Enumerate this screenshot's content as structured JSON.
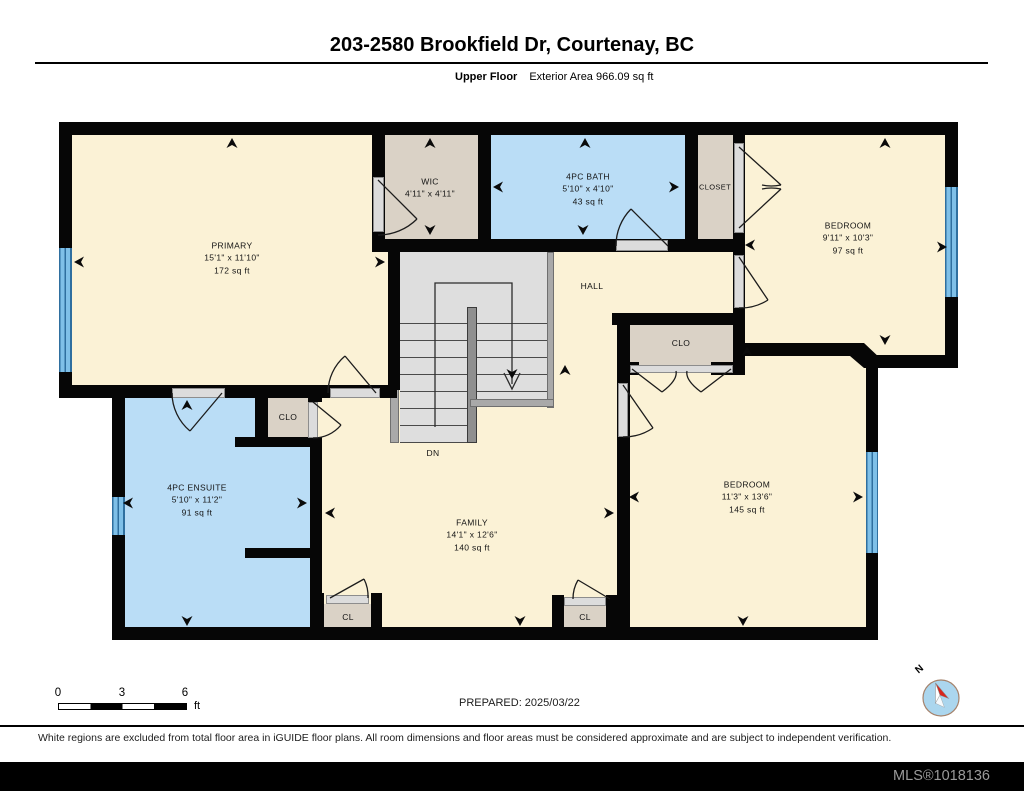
{
  "header": {
    "title": "203-2580 Brookfield Dr, Courtenay, BC",
    "floor_label": "Upper Floor",
    "area_label": "Exterior Area 966.09 sq ft"
  },
  "rooms": {
    "primary": {
      "name": "PRIMARY",
      "dims": "15'1\" x 11'10\"",
      "area": "172 sq ft"
    },
    "wic": {
      "name": "WIC",
      "dims": "4'11\" x 4'11\""
    },
    "bath": {
      "name": "4PC BATH",
      "dims": "5'10\" x 4'10\"",
      "area": "43 sq ft"
    },
    "closet_top": {
      "name": "CLOSET"
    },
    "bedroom_top": {
      "name": "BEDROOM",
      "dims": "9'11\" x 10'3\"",
      "area": "97 sq ft"
    },
    "hall": {
      "name": "HALL"
    },
    "clo_mid": {
      "name": "CLO"
    },
    "clo_small": {
      "name": "CLO"
    },
    "ensuite": {
      "name": "4PC ENSUITE",
      "dims": "5'10\" x 11'2\"",
      "area": "91 sq ft"
    },
    "family": {
      "name": "FAMILY",
      "dims": "14'1\" x 12'6\"",
      "area": "140 sq ft"
    },
    "bedroom_bottom": {
      "name": "BEDROOM",
      "dims": "11'3\" x 13'6\"",
      "area": "145 sq ft"
    },
    "cl_left": {
      "name": "CL"
    },
    "cl_right": {
      "name": "CL"
    },
    "stairs": {
      "label": "DN"
    }
  },
  "scale_bar": {
    "ticks": [
      "0",
      "3",
      "6"
    ],
    "unit": "ft"
  },
  "compass": {
    "label": "N"
  },
  "footer": {
    "prepared": "PREPARED: 2025/03/22",
    "disclaimer": "White regions are excluded from total floor area in iGUIDE floor plans. All room dimensions and floor areas must be considered approximate and are subject to independent verification.",
    "mls": "MLS®1018136"
  },
  "colors": {
    "room_fill": "#FBF2D6",
    "closet_fill": "#DAD2C6",
    "wet_room_fill": "#BADDF6",
    "window_blue": "#5FA8D8",
    "wall": "#060606"
  }
}
